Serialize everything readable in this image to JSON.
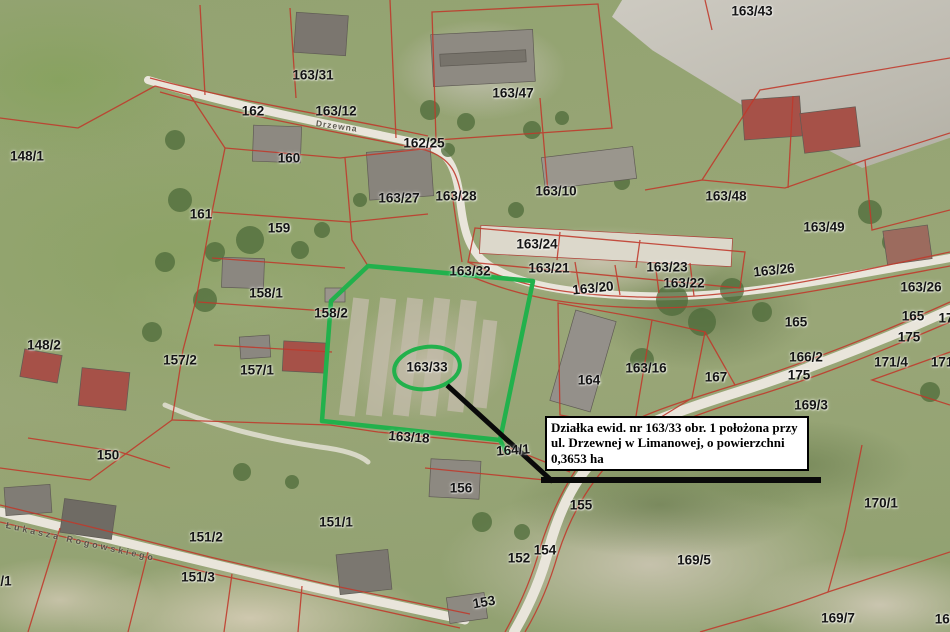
{
  "map_type": "cadastral-aerial-map",
  "highlight": {
    "parcel": "163/33",
    "shape": "green-polygon-with-ellipse"
  },
  "annotation": {
    "text": "Działka ewid. nr 163/33 obr. 1 położona przy ul. Drzewnej w Limanowej, o powierzchni 0,3653 ha"
  },
  "colors": {
    "parcel_line": "#c0392b",
    "highlight_green": "#22b14c",
    "road": "#e9e5db",
    "pointer": "#0a0a0a",
    "annotation_bg": "#ffffff",
    "annotation_border": "#000000"
  },
  "street_labels": [
    {
      "text": "Drzewna",
      "x": 316,
      "y": 118,
      "rot": 8,
      "size": 8.5,
      "spacing": 1
    },
    {
      "text": "Łukasza Rogowskiego",
      "x": 6,
      "y": 520,
      "rot": 12.5,
      "size": 9,
      "spacing": 3
    }
  ],
  "parcel_labels": [
    {
      "text": "148/1",
      "x": 27,
      "y": 156
    },
    {
      "text": "163/31",
      "x": 313,
      "y": 75
    },
    {
      "text": "162",
      "x": 253,
      "y": 111
    },
    {
      "text": "163/12",
      "x": 336,
      "y": 111
    },
    {
      "text": "162/25",
      "x": 424,
      "y": 143
    },
    {
      "text": "163/47",
      "x": 513,
      "y": 93
    },
    {
      "text": "163/43",
      "x": 752,
      "y": 11
    },
    {
      "text": "160",
      "x": 289,
      "y": 158
    },
    {
      "text": "161",
      "x": 201,
      "y": 214
    },
    {
      "text": "159",
      "x": 279,
      "y": 228
    },
    {
      "text": "163/27",
      "x": 399,
      "y": 198
    },
    {
      "text": "163/28",
      "x": 456,
      "y": 196
    },
    {
      "text": "163/10",
      "x": 556,
      "y": 191
    },
    {
      "text": "163/48",
      "x": 726,
      "y": 196
    },
    {
      "text": "163/49",
      "x": 824,
      "y": 227
    },
    {
      "text": "163/24",
      "x": 537,
      "y": 244
    },
    {
      "text": "163/21",
      "x": 549,
      "y": 268
    },
    {
      "text": "163/32",
      "x": 470,
      "y": 271
    },
    {
      "text": "163/20",
      "x": 593,
      "y": 288,
      "rot": -6
    },
    {
      "text": "163/23",
      "x": 667,
      "y": 267
    },
    {
      "text": "163/22",
      "x": 684,
      "y": 283
    },
    {
      "text": "163/26",
      "x": 774,
      "y": 270,
      "rot": -6
    },
    {
      "text": "163/26",
      "x": 921,
      "y": 287
    },
    {
      "text": "158/1",
      "x": 266,
      "y": 293
    },
    {
      "text": "158/2",
      "x": 331,
      "y": 313
    },
    {
      "text": "148/2",
      "x": 44,
      "y": 345
    },
    {
      "text": "157/2",
      "x": 180,
      "y": 360
    },
    {
      "text": "157/1",
      "x": 257,
      "y": 370
    },
    {
      "text": "165",
      "x": 796,
      "y": 322
    },
    {
      "text": "165",
      "x": 913,
      "y": 316
    },
    {
      "text": "17",
      "x": 946,
      "y": 318
    },
    {
      "text": "175",
      "x": 909,
      "y": 337
    },
    {
      "text": "166/2",
      "x": 806,
      "y": 357
    },
    {
      "text": "175",
      "x": 799,
      "y": 375
    },
    {
      "text": "167",
      "x": 716,
      "y": 377
    },
    {
      "text": "164",
      "x": 589,
      "y": 380
    },
    {
      "text": "163/16",
      "x": 646,
      "y": 368
    },
    {
      "text": "171/4",
      "x": 891,
      "y": 362
    },
    {
      "text": "171/",
      "x": 944,
      "y": 362
    },
    {
      "text": "169/3",
      "x": 811,
      "y": 405
    },
    {
      "text": "163/33",
      "x": 427,
      "y": 367
    },
    {
      "text": "163/18",
      "x": 409,
      "y": 437,
      "rot": 4
    },
    {
      "text": "164/1",
      "x": 513,
      "y": 450,
      "rot": -4
    },
    {
      "text": "150",
      "x": 108,
      "y": 455
    },
    {
      "text": "156",
      "x": 461,
      "y": 488
    },
    {
      "text": "155",
      "x": 581,
      "y": 505
    },
    {
      "text": "170/1",
      "x": 881,
      "y": 503
    },
    {
      "text": "151/1",
      "x": 336,
      "y": 522
    },
    {
      "text": "151/2",
      "x": 206,
      "y": 537
    },
    {
      "text": "154",
      "x": 545,
      "y": 550
    },
    {
      "text": "152",
      "x": 519,
      "y": 558
    },
    {
      "text": "169/5",
      "x": 694,
      "y": 560
    },
    {
      "text": "151/3",
      "x": 198,
      "y": 577
    },
    {
      "text": "/1",
      "x": 6,
      "y": 581
    },
    {
      "text": "153",
      "x": 484,
      "y": 602,
      "rot": -10
    },
    {
      "text": "169/7",
      "x": 838,
      "y": 618
    },
    {
      "text": "169",
      "x": 946,
      "y": 619
    }
  ]
}
